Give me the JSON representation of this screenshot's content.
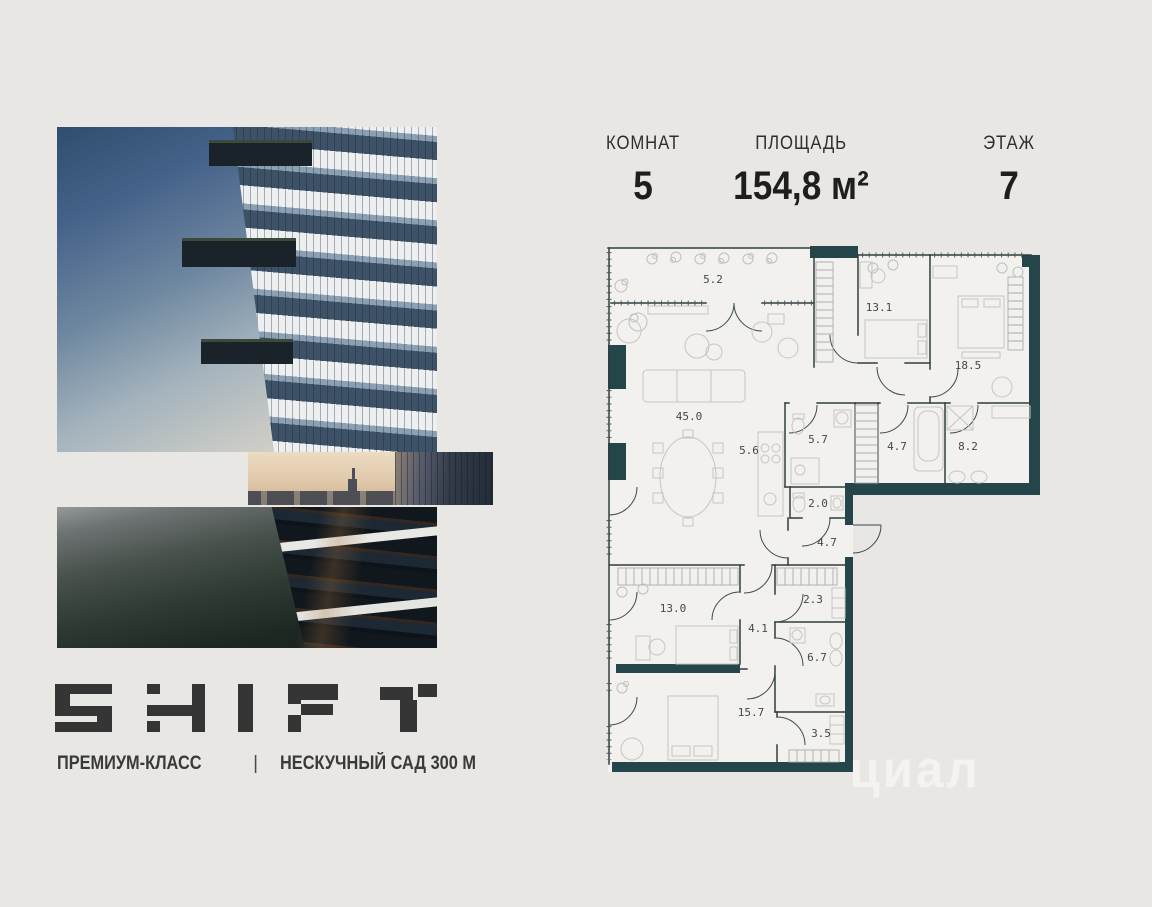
{
  "header": {
    "columns": [
      {
        "label": "КОМНАТ",
        "value": "5"
      },
      {
        "label": "ПЛОЩАДЬ",
        "value": "154,8 м²"
      },
      {
        "label": "ЭТАЖ",
        "value": "7"
      }
    ]
  },
  "brand": {
    "logo_text": "SHIFT",
    "class_label": "ПРЕМИУМ-КЛАСС",
    "divider": "|",
    "location_label": "НЕСКУЧНЫЙ САД 300 М"
  },
  "floor_plan": {
    "rooms": [
      {
        "name": "terrace",
        "area": "5.2"
      },
      {
        "name": "bedroom-1",
        "area": "13.1"
      },
      {
        "name": "bedroom-2",
        "area": "18.5"
      },
      {
        "name": "living-room",
        "area": "45.0"
      },
      {
        "name": "kitchen",
        "area": "5.6"
      },
      {
        "name": "bathroom-1",
        "area": "5.7"
      },
      {
        "name": "bathroom-2",
        "area": "4.7"
      },
      {
        "name": "bathroom-3",
        "area": "8.2"
      },
      {
        "name": "wc",
        "area": "2.0"
      },
      {
        "name": "entry-hall",
        "area": "4.7"
      },
      {
        "name": "bedroom-3",
        "area": "13.0"
      },
      {
        "name": "closet",
        "area": "2.3"
      },
      {
        "name": "hallway",
        "area": "4.1"
      },
      {
        "name": "bathroom-4",
        "area": "6.7"
      },
      {
        "name": "bedroom-4",
        "area": "15.7"
      },
      {
        "name": "dressing",
        "area": "3.5"
      }
    ]
  },
  "watermark": {
    "text": "циал"
  },
  "colors": {
    "wall_teal": "#24454a",
    "background": "#e9e7e4",
    "ink": "#353535"
  }
}
